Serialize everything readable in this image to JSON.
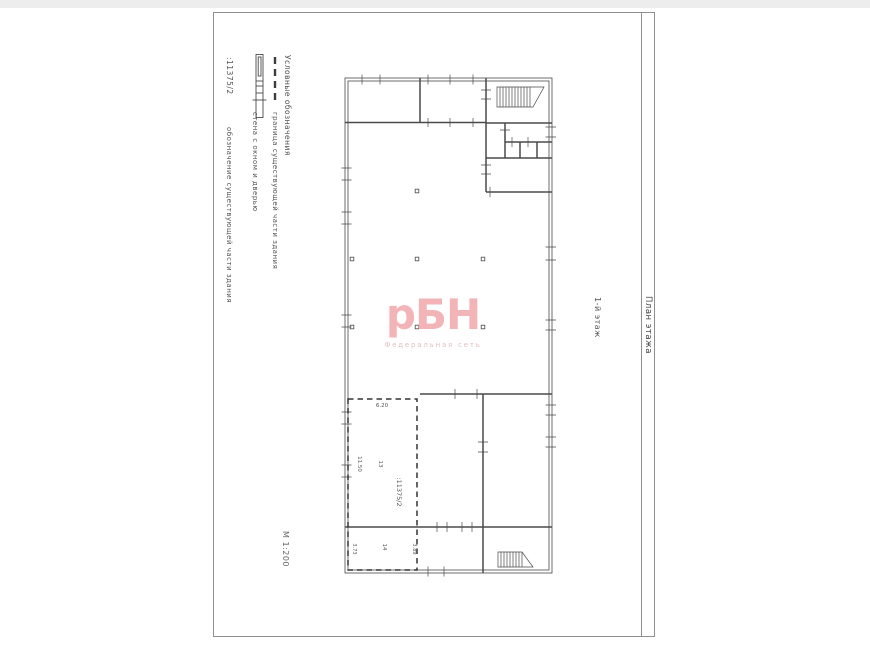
{
  "document": {
    "title_block": "План этажа",
    "floor_label": "1-й этаж",
    "scale": "М 1:200"
  },
  "legend": {
    "title": "Условные обозначения",
    "items": [
      {
        "symbol": "dashed-boundary-line",
        "label": "граница существующей части здания"
      },
      {
        "symbol": "wall-with-window-and-door",
        "label": "стена с окном и дверью"
      },
      {
        "symbol_text": ":11375/2",
        "label": "обозначение существующей части здания"
      }
    ]
  },
  "plan": {
    "labels": {
      "dim_top": "6.20",
      "dim_left": "11.50",
      "room_13": "13",
      "cadastral": ":11375/2",
      "dim_room14_left": "3.73",
      "room_14": "14",
      "dim_room14_right": "3.89"
    }
  },
  "watermark": {
    "logo": "рБН",
    "subtitle": "Федеральная сеть"
  },
  "colors": {
    "watermark_logo": "#f3b4b8",
    "watermark_subtitle": "#ddbfc2",
    "plan_line": "#4a4a4a",
    "frame_line": "#8f8f8f",
    "text": "#555555"
  }
}
